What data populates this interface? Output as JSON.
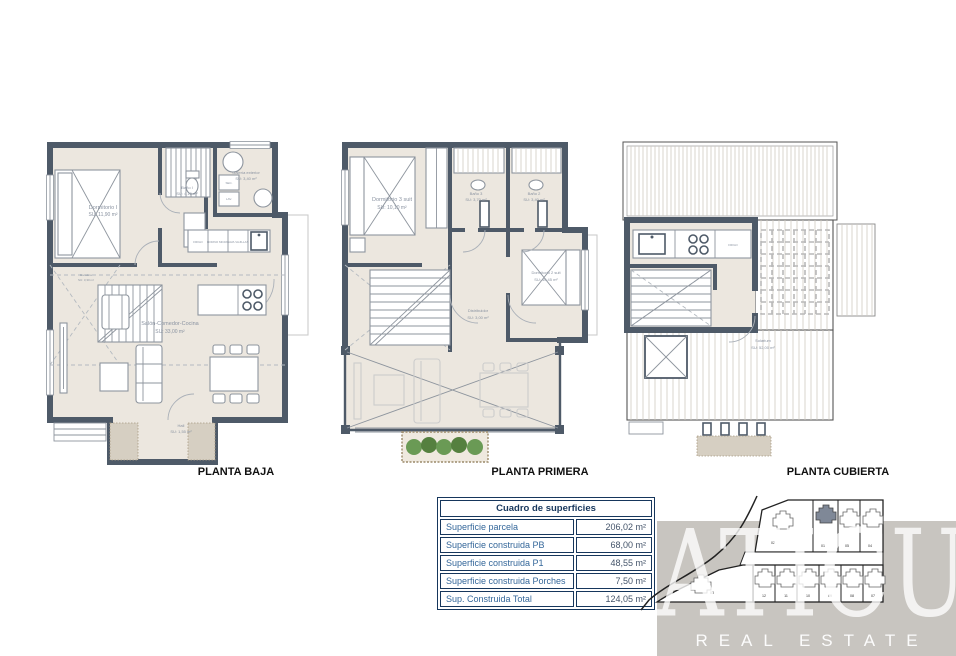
{
  "plans": [
    {
      "title": "PLANTA BAJA",
      "rooms": {
        "dormitorio1": {
          "name": "Dormitorio I",
          "area": "SU: 11,90 m²"
        },
        "bano1": {
          "name": "Baño I",
          "area": "SU: 4,10 m²"
        },
        "galeria": {
          "name": "Galería exterior",
          "area": "SU: 3,40 m²"
        },
        "salon": {
          "name": "Salón-Comedor-Cocina",
          "area": "SU: 33,00 m²"
        },
        "escalera": {
          "name": "Escalera",
          "area": "SU: 3,30 m²"
        },
        "hall": {
          "name": "Hall",
          "area": "SU: 1,55 m²"
        }
      },
      "labels": {
        "frigo": "FRIGO",
        "horno": "HORNO MICRO",
        "lava": "LAVA VAJILLAS",
        "sec": "SEC.",
        "lav": "LAV."
      }
    },
    {
      "title": "PLANTA PRIMERA",
      "rooms": {
        "dormitorio3": {
          "name": "Dormitorio 3 suit",
          "area": "SU: 10,10 m²"
        },
        "bano3": {
          "name": "Baño 3",
          "area": "SU: 3,70 m²"
        },
        "bano2": {
          "name": "Baño 2",
          "area": "SU: 3,40 m²"
        },
        "dormitorio2": {
          "name": "Dormitorio 2 suit",
          "area": "SU: 10,45 m²"
        },
        "distribuidor": {
          "name": "Distribuidor",
          "area": "SU: 3,00 m²"
        }
      }
    },
    {
      "title": "PLANTA CUBIERTA",
      "rooms": {
        "solarium": {
          "name": "Solarium",
          "area": "SU: 52,00 m²"
        }
      },
      "labels": {
        "frigo": "FRIGO"
      }
    }
  ],
  "table": {
    "header": "Cuadro de superficies",
    "rows": [
      {
        "label": "Superficie parcela",
        "value": "206,02 m²"
      },
      {
        "label": "Superficie construida PB",
        "value": "68,00 m²"
      },
      {
        "label": "Superficie construida P1",
        "value": "48,55 m²"
      },
      {
        "label": "Superficie construida Porches",
        "value": "7,50 m²"
      },
      {
        "label": "Sup. Construida Total",
        "value": "124,05 m²"
      }
    ]
  },
  "site_plan": {
    "lots": [
      "02",
      "01",
      "05",
      "04",
      "03",
      "12",
      "11",
      "10",
      "09",
      "08",
      "07"
    ],
    "highlighted_lot": "01"
  },
  "brand": {
    "name": "ATICÚ",
    "tagline": "REAL ESTATE"
  },
  "colors": {
    "wall": "#4e5a68",
    "floor": "#ece7df",
    "room_label": "#8a93a1",
    "table_border": "#16365c",
    "table_label": "#34679a",
    "table_value": "#44546a",
    "brand_bg": "#c8c5c0",
    "plant_green": "#6a9a55",
    "planter_brown": "#9c8a6a",
    "highlight_lot": "#7f8897"
  }
}
